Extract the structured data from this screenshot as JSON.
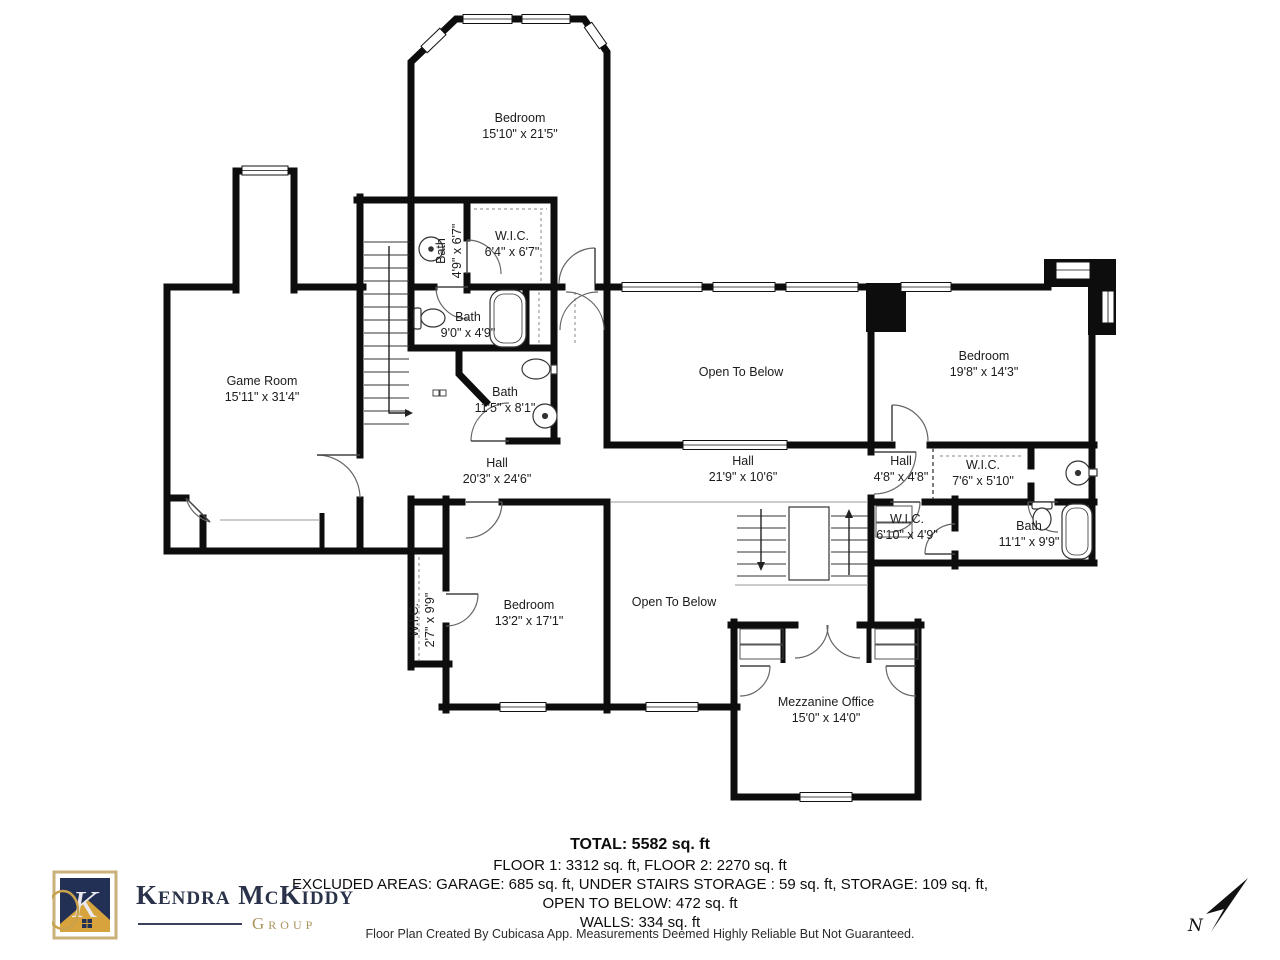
{
  "rooms": [
    {
      "name": "Bedroom",
      "dims": "15'10\" x 21'5\""
    },
    {
      "name": "Bath",
      "dims": "4'9\" x 6'7\""
    },
    {
      "name": "W.I.C.",
      "dims": "6'4\" x 6'7\""
    },
    {
      "name": "Bath",
      "dims": "9'0\" x 4'9\""
    },
    {
      "name": "Bath",
      "dims": "11'5\" x 8'1\""
    },
    {
      "name": "Game Room",
      "dims": "15'11\" x 31'4\""
    },
    {
      "name": "Hall",
      "dims": "20'3\" x 24'6\""
    },
    {
      "name": "Open To Below",
      "dims": ""
    },
    {
      "name": "Hall",
      "dims": "21'9\" x 10'6\""
    },
    {
      "name": "Bedroom",
      "dims": "19'8\" x 14'3\""
    },
    {
      "name": "Hall",
      "dims": "4'8\" x 4'8\""
    },
    {
      "name": "W.I.C.",
      "dims": "7'6\" x 5'10\""
    },
    {
      "name": "W.I.C.",
      "dims": "6'10\" x 4'9\""
    },
    {
      "name": "Bath",
      "dims": "11'1\" x 9'9\""
    },
    {
      "name": "W.I.C.",
      "dims": "2'7\" x 9'9\""
    },
    {
      "name": "Bedroom",
      "dims": "13'2\" x 17'1\""
    },
    {
      "name": "Open To Below",
      "dims": ""
    },
    {
      "name": "Mezzanine Office",
      "dims": "15'0\" x 14'0\""
    }
  ],
  "totals": {
    "total": "TOTAL: 5582 sq. ft",
    "floors": "FLOOR 1: 3312 sq. ft, FLOOR 2: 2270 sq. ft",
    "excluded": "EXCLUDED AREAS: GARAGE: 685 sq. ft, UNDER STAIRS STORAGE : 59 sq. ft, STORAGE: 109 sq. ft,",
    "open_to_below": "OPEN TO BELOW: 472 sq. ft",
    "walls": "WALLS: 334 sq. ft"
  },
  "disclaimer": "Floor Plan Created By Cubicasa App. Measurements Deemed Highly Reliable But Not Guaranteed.",
  "branding": {
    "name": "Kendra McKiddy",
    "group": "Group",
    "monogram": "K"
  },
  "compass": {
    "label": "N"
  },
  "colors": {
    "wall": "#0d0d0d",
    "brand_navy": "#223055",
    "brand_gold": "#d6a33c",
    "brand_gold_text": "#ab935c"
  }
}
